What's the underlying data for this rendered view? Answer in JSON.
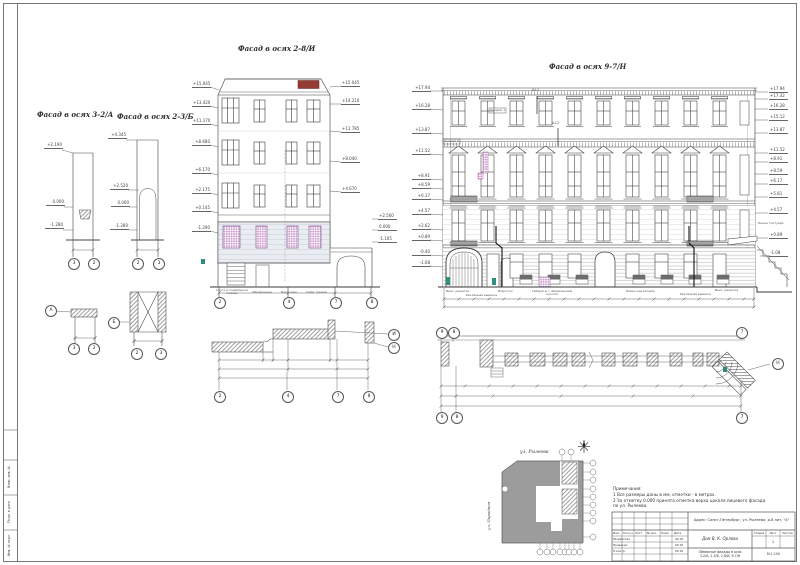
{
  "sheet": {
    "frame_side_labels": [
      "Взам. инв. №",
      "Подп. и дата",
      "Инв. № подл."
    ]
  },
  "titles": {
    "facade_a": "Фасад в осях 3-2/А",
    "facade_b": "Фасад в осях 2-3/Б",
    "facade_center": "Фасад в осях 2-8/И",
    "facade_right": "Фасад в осях 9-7/Н"
  },
  "axes": {
    "fa": [
      "3",
      "2"
    ],
    "fb": [
      "2",
      "3"
    ],
    "fc": [
      "2",
      "4",
      "7",
      "8"
    ],
    "fc_plan": [
      "2",
      "4",
      "7",
      "8"
    ],
    "fc_plan_side": [
      "И",
      "Н"
    ],
    "da_side": "А",
    "da": [
      "3",
      "2"
    ],
    "db_side": "Б",
    "db": [
      "2",
      "3"
    ],
    "fr_plan_top": [
      "9",
      "8",
      "7"
    ],
    "fr_plan_bottom": [
      "9",
      "8",
      "7"
    ],
    "fr_plan_side": "Н"
  },
  "elev": {
    "fa": [
      "+2.190",
      "0.000",
      "-1.280"
    ],
    "fb": [
      "+4.345",
      "+2.520",
      "0.000",
      "-1.280"
    ],
    "fc_left": [
      "+15.045",
      "+13.420",
      "+11.170",
      "+8.680",
      "+6.170",
      "+2.175",
      "+0.145",
      "-1.290"
    ],
    "fc_right": [
      "+15.045",
      "+14.210",
      "+11.785",
      "+8.040",
      "+4.670",
      "+2.560",
      "0.000",
      "-1.105"
    ],
    "fr_left": [
      "+17.94",
      "+16.28",
      "+13.87",
      "+11.52",
      "+8.91",
      "+8.59",
      "+6.17",
      "+4.57",
      "+2.62",
      "+0.89",
      "-0.40",
      "-1.08"
    ],
    "fr_right": [
      "+17.94",
      "+17.32",
      "+16.28",
      "+15.12",
      "+13.87",
      "+11.52",
      "+8.91",
      "+8.59",
      "+6.17",
      "+5.81",
      "+4.57",
      "+0.89",
      "-1.08"
    ],
    "sidewalk": "Линия тротуара"
  },
  "ann": {
    "probe1": "Ш-1",
    "probe2": "Ш-2",
    "zond1": "Зондаж 1",
    "zond2": "Зондаж 2",
    "fr_bottom": [
      "Вент. решетки",
      "Рекламная вывеска",
      "Водосток",
      "Габариты с обрамлением цоколя",
      "Навес над входом",
      "Рекламная вывеска",
      "Вент. решетка"
    ],
    "fc_bottom": [
      "Спуск в подвальное помещ.",
      "Обрамление",
      "Вент. реш.",
      "Сайд. панель"
    ]
  },
  "site": {
    "street_top": "ул. Рылеева",
    "street_left": "ул. Парадная"
  },
  "notes": {
    "title": "Примечания:",
    "line1": "1   Все размеры даны в мм, отметки - в метрах.",
    "line2": "2   За отметку 0.000 принята отметка верха цоколя лицевого фасада",
    "line3": "     по ул. Рылеева."
  },
  "stamp": {
    "address": "Адрес: Санкт-Петербург, ул. Рылеева, д.8 лит. \"А\"",
    "object": "Дом В. К. Орлова",
    "drawing1": "Обмерные фасады в осях",
    "drawing2": "3-2/А, 2-3/Б, 2-8/И, 9-7/Н",
    "scale": "М 1:100",
    "col_izm": "Изм.",
    "col_koluch": "Кол.уч.",
    "col_list": "Лист",
    "col_doc": "№ док.",
    "col_podp": "Подп.",
    "col_data": "Дата",
    "stage_h": "Стадия",
    "list_h": "Лист",
    "listov_h": "Листов",
    "sheet_no": "1",
    "row1_role": "Разработал",
    "row2_role": "Проверил",
    "row3_role": "Н.контр.",
    "date": "09.18"
  }
}
